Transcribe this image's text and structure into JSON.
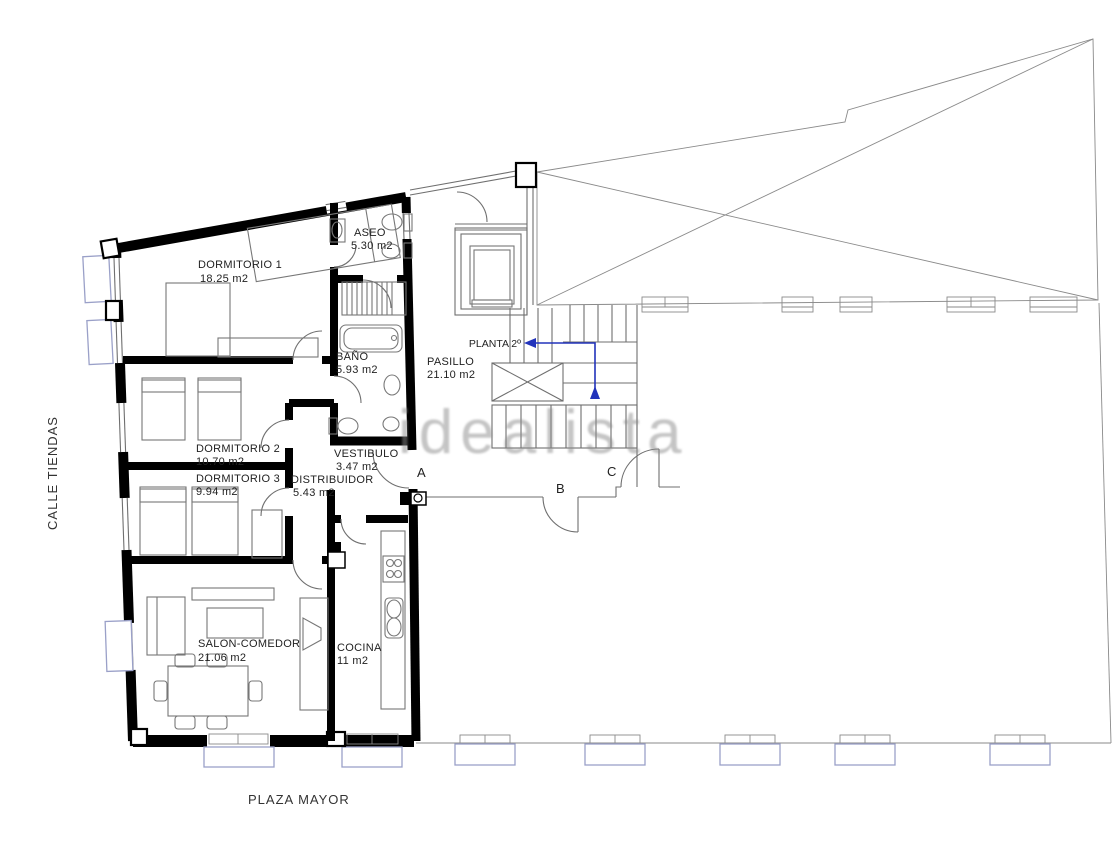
{
  "plan": {
    "streets": {
      "left": "CALLE TIENDAS",
      "bottom": "PLAZA MAYOR"
    },
    "watermark": "idealista",
    "floor_note": "PLANTA 2º",
    "rooms": {
      "dormitorio1": {
        "name": "DORMITORIO 1",
        "area": "18.25 m2"
      },
      "dormitorio2": {
        "name": "DORMITORIO 2",
        "area": "10.70 m2"
      },
      "dormitorio3": {
        "name": "DORMITORIO 3",
        "area": "9.94 m2"
      },
      "salon": {
        "name": "SALON-COMEDOR",
        "area": "21.06 m2"
      },
      "cocina": {
        "name": "COCINA",
        "area": "11 m2"
      },
      "bano": {
        "name": "BAÑO",
        "area": "5.93 m2"
      },
      "aseo": {
        "name": "ASEO",
        "area": "5.30 m2"
      },
      "vestibulo": {
        "name": "VESTIBULO",
        "area": "3.47 m2"
      },
      "distribuidor": {
        "name": "DISTRIBUIDOR",
        "area": "5.43 m2"
      },
      "pasillo": {
        "name": "PASILLO",
        "area": "21.10 m2"
      }
    },
    "markers": {
      "a": "A",
      "b": "B",
      "c": "C"
    },
    "colors": {
      "walls": "#000000",
      "lines": "#6f6f6f",
      "windows": "#9aa0c8",
      "stairs_arrow": "#2233bb",
      "watermark": "#8a8a8a"
    }
  }
}
